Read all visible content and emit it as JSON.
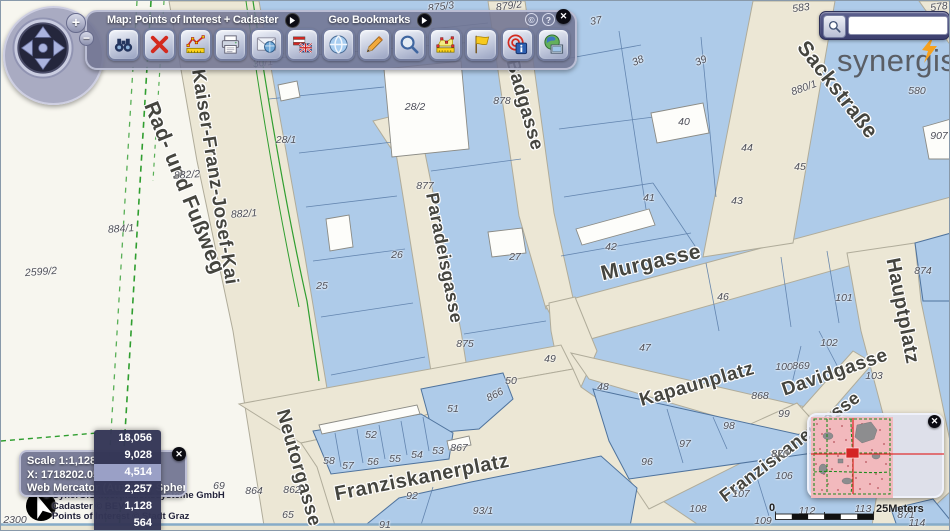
{
  "toolbar": {
    "map_menu_label": "Map: Points of Interest + Cadaster",
    "bookmarks_label": "Geo Bookmarks",
    "copyright_symbol": "©",
    "help_symbol": "?",
    "close_symbol": "✕",
    "buttons": [
      {
        "name": "find-button",
        "icon": "binoculars-icon"
      },
      {
        "name": "clear-selection-button",
        "icon": "red-x-icon"
      },
      {
        "name": "measure-profile-button",
        "icon": "measure-line-icon"
      },
      {
        "name": "print-button",
        "icon": "printer-icon"
      },
      {
        "name": "send-map-button",
        "icon": "envelope-globe-icon"
      },
      {
        "name": "language-button",
        "icon": "flags-icon"
      },
      {
        "name": "pan-globe-button",
        "icon": "globe-icon"
      },
      {
        "name": "draw-button",
        "icon": "pencil-icon"
      },
      {
        "name": "zoom-search-button",
        "icon": "magnifier-icon"
      },
      {
        "name": "measure-area-button",
        "icon": "area-ruler-icon"
      },
      {
        "name": "flag-button",
        "icon": "flag-icon"
      },
      {
        "name": "identify-button",
        "icon": "identify-target-icon"
      },
      {
        "name": "map-tip-button",
        "icon": "globe-document-icon"
      }
    ]
  },
  "nav": {
    "zoom_in": "+",
    "zoom_out": "−"
  },
  "search": {
    "value": "",
    "placeholder": ""
  },
  "logo": {
    "text": "synergis"
  },
  "status_panel": {
    "scale": "Scale 1:1,128",
    "coordinate": "X: 1718202.05",
    "projection": "Web Mercator (Auxiliary Sphere)",
    "close_symbol": "✕"
  },
  "scale_menu": {
    "options": [
      "18,056",
      "9,028",
      "4,514",
      "2,257",
      "1,128",
      "564"
    ],
    "selected": "4,514"
  },
  "copyright": {
    "lines": [
      "© SynerGIS Informationssysteme GmbH",
      "Cadaster © BEV",
      "Points of Interest © Stadt Graz"
    ]
  },
  "scalebar": {
    "zero": "0",
    "label": "25Meters"
  },
  "overview": {
    "close_symbol": "✕"
  },
  "map": {
    "streets": [
      {
        "t": "Rad- und Fußweg",
        "x": 183,
        "y": 187,
        "r": 68,
        "s": 21
      },
      {
        "t": "Kaiser-Franz-Josef-Kai",
        "x": 213,
        "y": 176,
        "r": 81,
        "s": 19
      },
      {
        "t": "Badgasse",
        "x": 523,
        "y": 104,
        "r": 74,
        "s": 19
      },
      {
        "t": "Paradeisgasse",
        "x": 443,
        "y": 257,
        "r": 79,
        "s": 18
      },
      {
        "t": "Murgasse",
        "x": 650,
        "y": 262,
        "r": -13,
        "s": 21
      },
      {
        "t": "Sackstraße",
        "x": 836,
        "y": 89,
        "r": 52,
        "s": 21
      },
      {
        "t": "Hauptplatz",
        "x": 901,
        "y": 310,
        "r": 79,
        "s": 20
      },
      {
        "t": "Kapaunplatz",
        "x": 696,
        "y": 384,
        "r": -16,
        "s": 19
      },
      {
        "t": "Davidgasse",
        "x": 834,
        "y": 372,
        "r": -19,
        "s": 19
      },
      {
        "t": "Franziskanerplatz",
        "x": 421,
        "y": 477,
        "r": -11,
        "s": 20
      },
      {
        "t": "Franziskanergasse",
        "x": 789,
        "y": 446,
        "r": -37,
        "s": 18
      },
      {
        "t": "Neutorgasse",
        "x": 297,
        "y": 467,
        "r": 74,
        "s": 19
      }
    ],
    "parcels": [
      {
        "t": "875/3",
        "x": 440,
        "y": 6,
        "r": -8
      },
      {
        "t": "879/2",
        "x": 508,
        "y": 5,
        "r": -8
      },
      {
        "t": "37",
        "x": 595,
        "y": 20,
        "r": -10
      },
      {
        "t": "38",
        "x": 637,
        "y": 60,
        "r": -24
      },
      {
        "t": "39",
        "x": 700,
        "y": 60,
        "r": -24
      },
      {
        "t": "583",
        "x": 800,
        "y": 7,
        "r": -8
      },
      {
        "t": "587",
        "x": 882,
        "y": 33,
        "r": -8
      },
      {
        "t": "578",
        "x": 938,
        "y": 6,
        "r": -8
      },
      {
        "t": "30/1",
        "x": 262,
        "y": 62,
        "r": -8
      },
      {
        "t": "28/2",
        "x": 414,
        "y": 106
      },
      {
        "t": "28/1",
        "x": 285,
        "y": 139
      },
      {
        "t": "878",
        "x": 501,
        "y": 100
      },
      {
        "t": "877",
        "x": 424,
        "y": 185
      },
      {
        "t": "882/2",
        "x": 186,
        "y": 174,
        "r": -4
      },
      {
        "t": "882/1",
        "x": 243,
        "y": 213,
        "r": -4
      },
      {
        "t": "884/1",
        "x": 120,
        "y": 228,
        "r": -4
      },
      {
        "t": "2599/2",
        "x": 40,
        "y": 271,
        "r": -4
      },
      {
        "t": "25",
        "x": 321,
        "y": 285
      },
      {
        "t": "26",
        "x": 396,
        "y": 254
      },
      {
        "t": "27",
        "x": 514,
        "y": 256
      },
      {
        "t": "41",
        "x": 648,
        "y": 197
      },
      {
        "t": "42",
        "x": 610,
        "y": 246
      },
      {
        "t": "40",
        "x": 683,
        "y": 121
      },
      {
        "t": "44",
        "x": 746,
        "y": 147
      },
      {
        "t": "45",
        "x": 799,
        "y": 166
      },
      {
        "t": "43",
        "x": 736,
        "y": 200
      },
      {
        "t": "46",
        "x": 722,
        "y": 296
      },
      {
        "t": "101",
        "x": 843,
        "y": 297
      },
      {
        "t": "874",
        "x": 922,
        "y": 270
      },
      {
        "t": "880/1",
        "x": 803,
        "y": 87,
        "r": -20
      },
      {
        "t": "580",
        "x": 916,
        "y": 90
      },
      {
        "t": "907",
        "x": 938,
        "y": 135
      },
      {
        "t": "875",
        "x": 464,
        "y": 343
      },
      {
        "t": "49",
        "x": 549,
        "y": 358
      },
      {
        "t": "50",
        "x": 510,
        "y": 380
      },
      {
        "t": "866",
        "x": 494,
        "y": 394,
        "r": -28
      },
      {
        "t": "51",
        "x": 452,
        "y": 408
      },
      {
        "t": "47",
        "x": 644,
        "y": 347
      },
      {
        "t": "48",
        "x": 602,
        "y": 386
      },
      {
        "t": "52",
        "x": 370,
        "y": 434
      },
      {
        "t": "53",
        "x": 437,
        "y": 450
      },
      {
        "t": "867",
        "x": 458,
        "y": 447
      },
      {
        "t": "54",
        "x": 416,
        "y": 454
      },
      {
        "t": "55",
        "x": 394,
        "y": 458
      },
      {
        "t": "56",
        "x": 372,
        "y": 461
      },
      {
        "t": "57",
        "x": 347,
        "y": 465
      },
      {
        "t": "58",
        "x": 328,
        "y": 460
      },
      {
        "t": "92",
        "x": 411,
        "y": 495
      },
      {
        "t": "91",
        "x": 384,
        "y": 524
      },
      {
        "t": "93/1",
        "x": 482,
        "y": 510
      },
      {
        "t": "96",
        "x": 646,
        "y": 461
      },
      {
        "t": "97",
        "x": 684,
        "y": 443
      },
      {
        "t": "98",
        "x": 728,
        "y": 425
      },
      {
        "t": "99",
        "x": 783,
        "y": 413
      },
      {
        "t": "868",
        "x": 759,
        "y": 395
      },
      {
        "t": "100",
        "x": 783,
        "y": 366
      },
      {
        "t": "869",
        "x": 800,
        "y": 365
      },
      {
        "t": "102",
        "x": 828,
        "y": 342
      },
      {
        "t": "103",
        "x": 873,
        "y": 375
      },
      {
        "t": "870",
        "x": 779,
        "y": 453
      },
      {
        "t": "106",
        "x": 783,
        "y": 475
      },
      {
        "t": "107",
        "x": 740,
        "y": 493
      },
      {
        "t": "108",
        "x": 697,
        "y": 508
      },
      {
        "t": "109",
        "x": 762,
        "y": 520
      },
      {
        "t": "112",
        "x": 806,
        "y": 510
      },
      {
        "t": "113",
        "x": 862,
        "y": 508
      },
      {
        "t": "114",
        "x": 916,
        "y": 522
      },
      {
        "t": "871",
        "x": 905,
        "y": 514
      },
      {
        "t": "864",
        "x": 253,
        "y": 490
      },
      {
        "t": "862",
        "x": 291,
        "y": 489
      },
      {
        "t": "65",
        "x": 287,
        "y": 514
      },
      {
        "t": "69",
        "x": 218,
        "y": 485
      },
      {
        "t": "2300",
        "x": 14,
        "y": 519
      }
    ]
  }
}
